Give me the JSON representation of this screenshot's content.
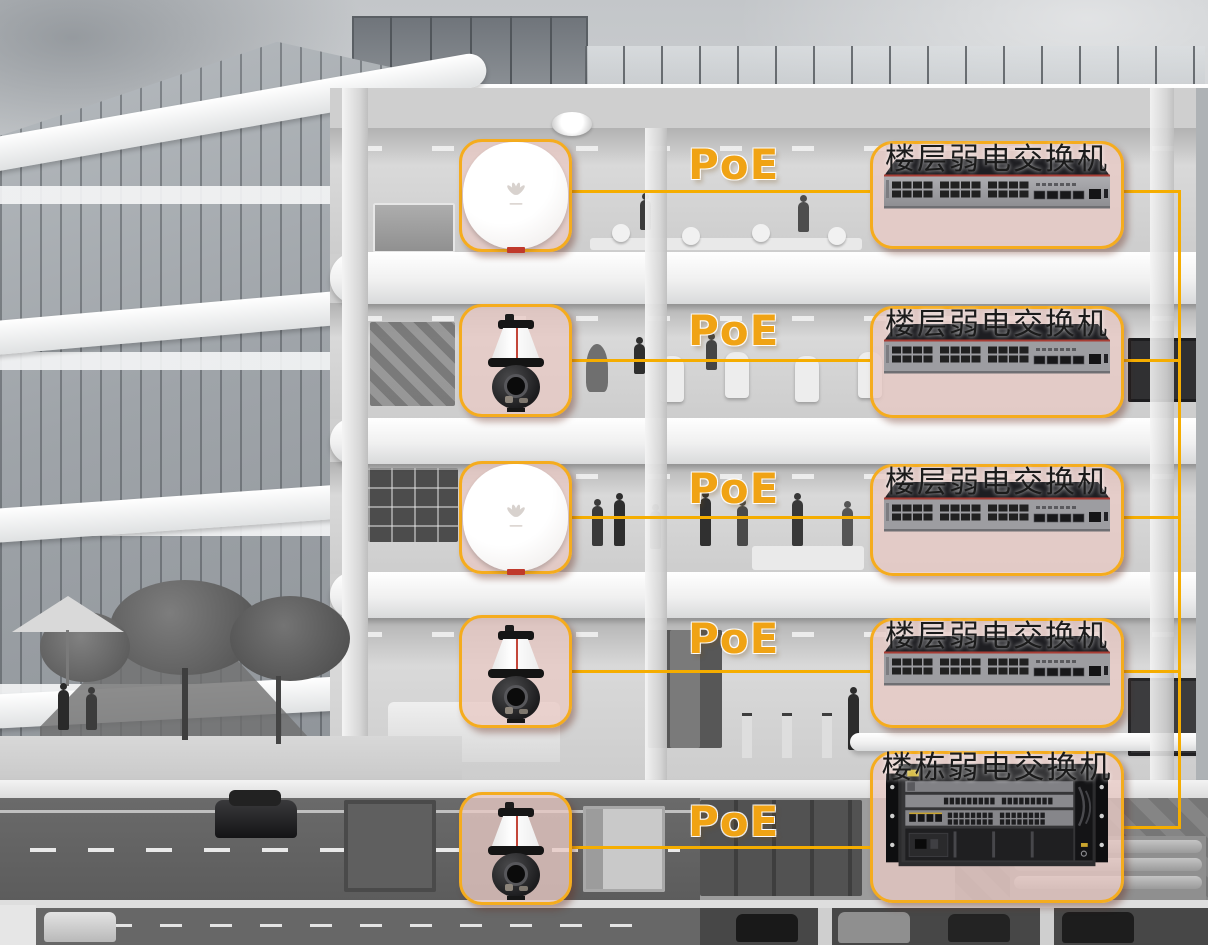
{
  "diagram_title": "PoE building network (per-floor devices to weak-current switches)",
  "colors": {
    "accent": "#F5AC1E",
    "line": "#F5AD00",
    "poe": "#F0A314",
    "boxfill": "rgba(232,201,196,0.78)",
    "labelcol": "#1b1b1b"
  },
  "floors": [
    {
      "device_icon": "wireless-ap-icon",
      "poe_label": "PoE",
      "switch_label": "楼层弱电交换机",
      "switch_icon": "ethernet-switch-icon"
    },
    {
      "device_icon": "ptz-camera-icon",
      "poe_label": "PoE",
      "switch_label": "楼层弱电交换机",
      "switch_icon": "ethernet-switch-icon"
    },
    {
      "device_icon": "wireless-ap-icon",
      "poe_label": "PoE",
      "switch_label": "楼层弱电交换机",
      "switch_icon": "ethernet-switch-icon"
    },
    {
      "device_icon": "ptz-camera-icon",
      "poe_label": "PoE",
      "switch_label": "楼层弱电交换机",
      "switch_icon": "ethernet-switch-icon"
    },
    {
      "device_icon": "ptz-camera-icon",
      "poe_label": "PoE",
      "switch_label": "楼栋弱电交换机",
      "switch_icon": "chassis-switch-icon"
    }
  ]
}
